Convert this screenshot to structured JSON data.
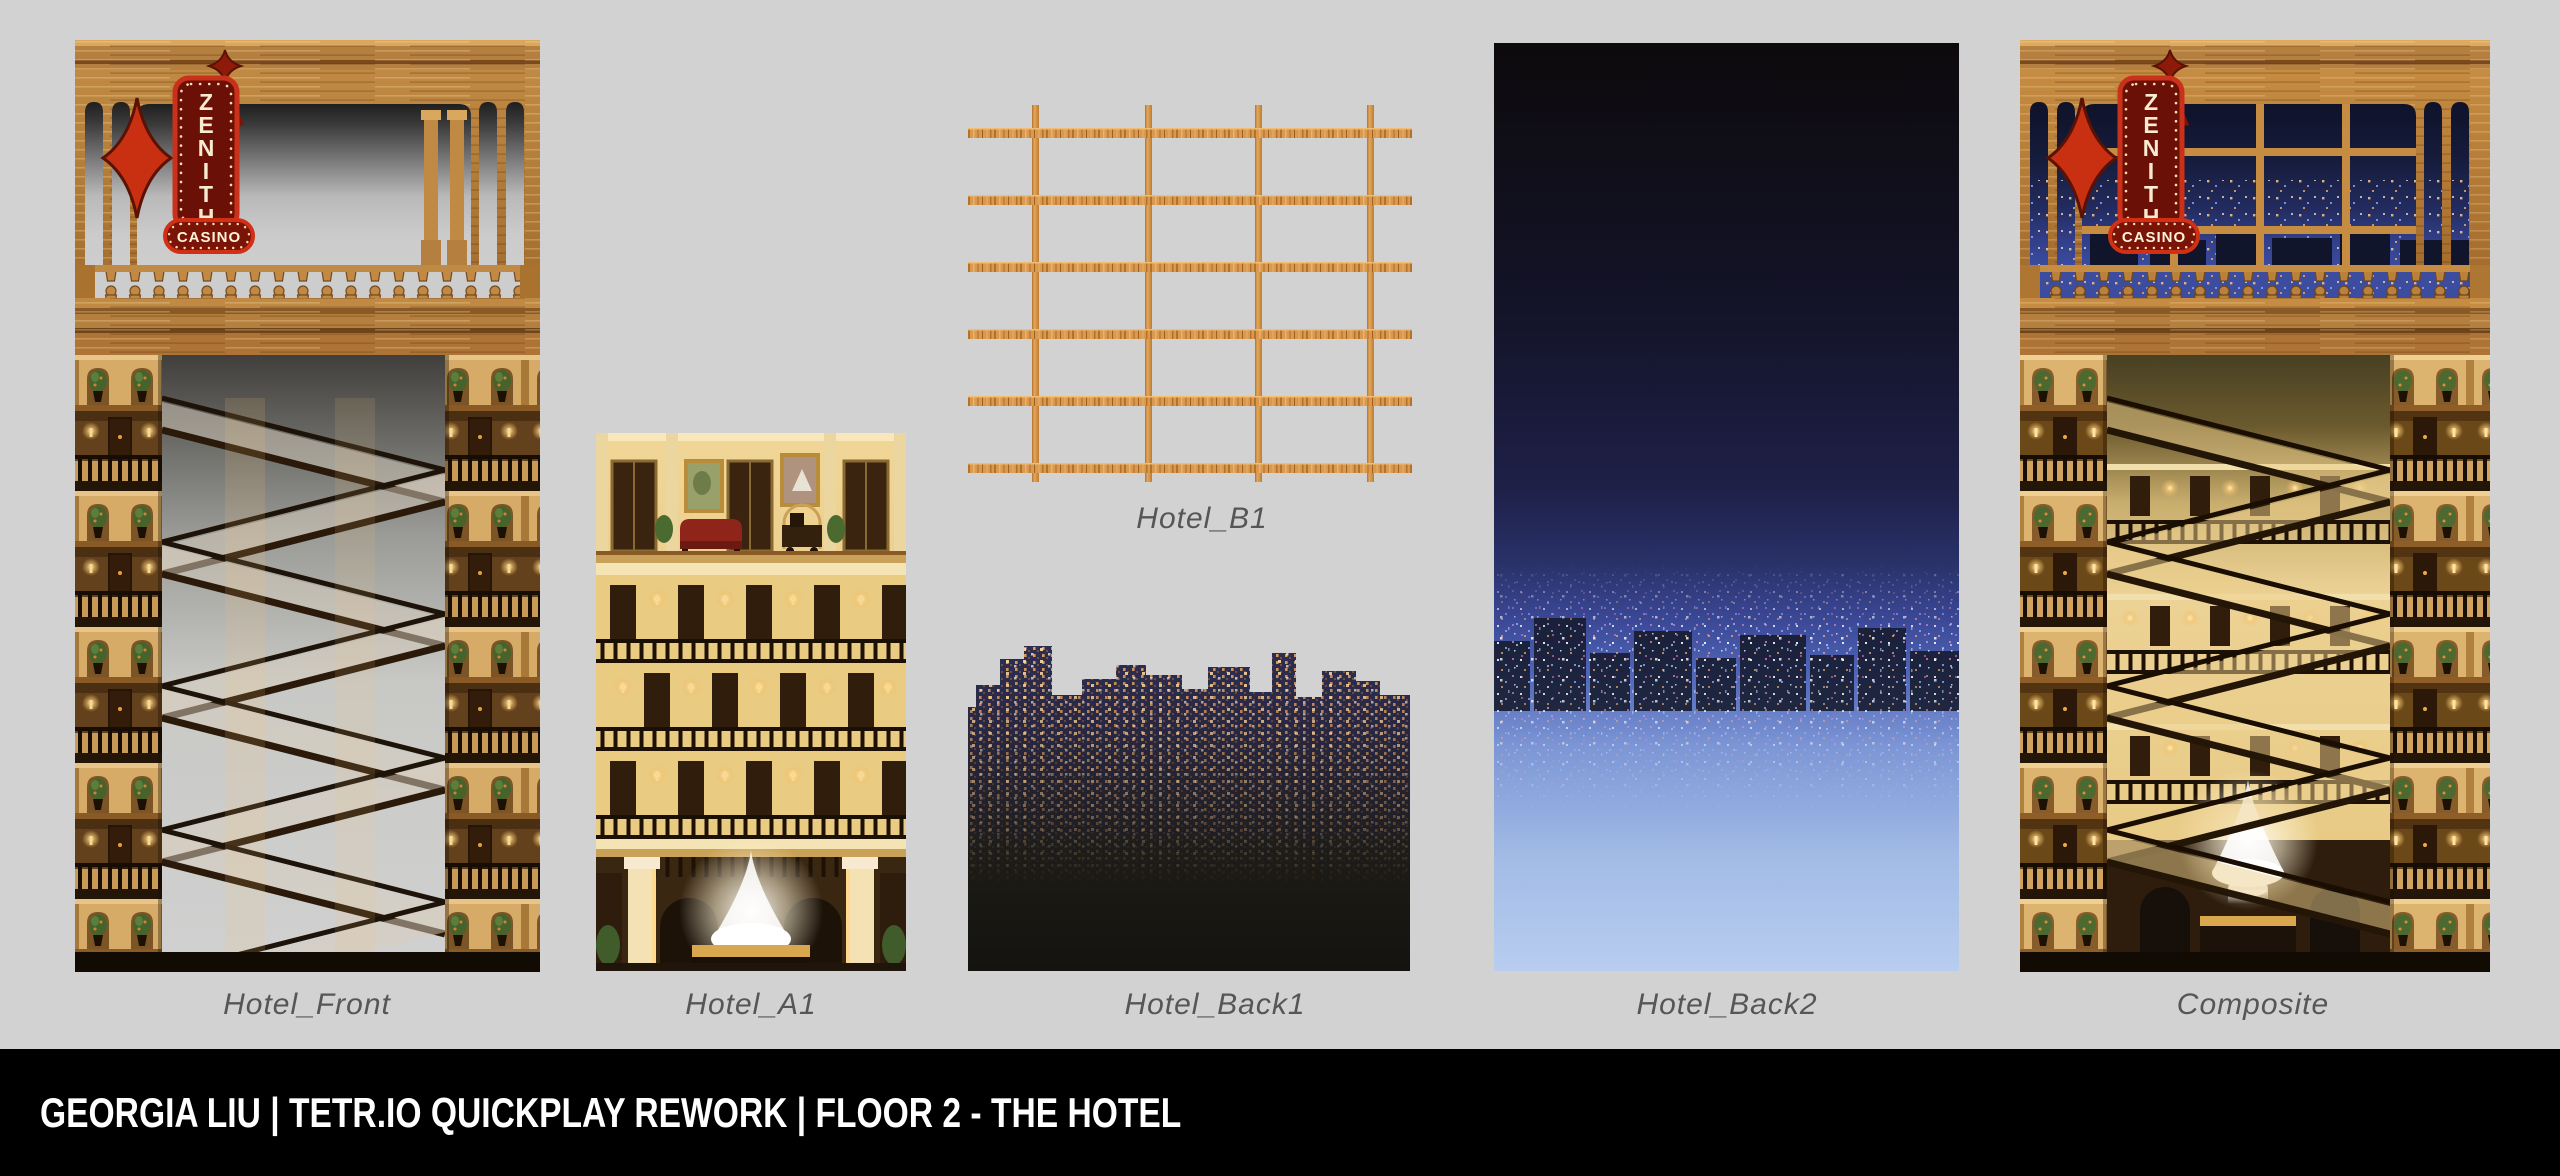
{
  "page": {
    "background": "#d2d2d2"
  },
  "footer": {
    "text": "GEORGIA LIU | TETR.IO QUICKPLAY REWORK | FLOOR 2 - THE HOTEL"
  },
  "sign": {
    "letters": [
      "Z",
      "E",
      "N",
      "I",
      "T",
      "H"
    ],
    "casino": "CASINO"
  },
  "panels": [
    {
      "id": "hotel-front",
      "label": "Hotel_Front"
    },
    {
      "id": "hotel-a1",
      "label": "Hotel_A1"
    },
    {
      "id": "hotel-b1",
      "label": "Hotel_B1"
    },
    {
      "id": "hotel-back1",
      "label": "Hotel_Back1"
    },
    {
      "id": "hotel-back2",
      "label": "Hotel_Back2"
    },
    {
      "id": "composite",
      "label": "Composite"
    }
  ],
  "colors": {
    "background": "#d2d2d2",
    "footer_bg": "#000000",
    "footer_text": "#ffffff",
    "label_text": "#565656",
    "sign_red": "#c9311a",
    "sign_maroon": "#6b1007",
    "bulb": "#ffe6b5",
    "wood": "#b5803f",
    "wood_light": "#d9a85e",
    "interior_gold": "#e9cb81",
    "night_sky_top": "#0d0a0c",
    "night_sky_blue": "#3a4795",
    "night_sky_bottom": "#b8cdef",
    "skyline_silhouette": "#2a2a4b",
    "window_light_orange": "#e8a05f"
  }
}
